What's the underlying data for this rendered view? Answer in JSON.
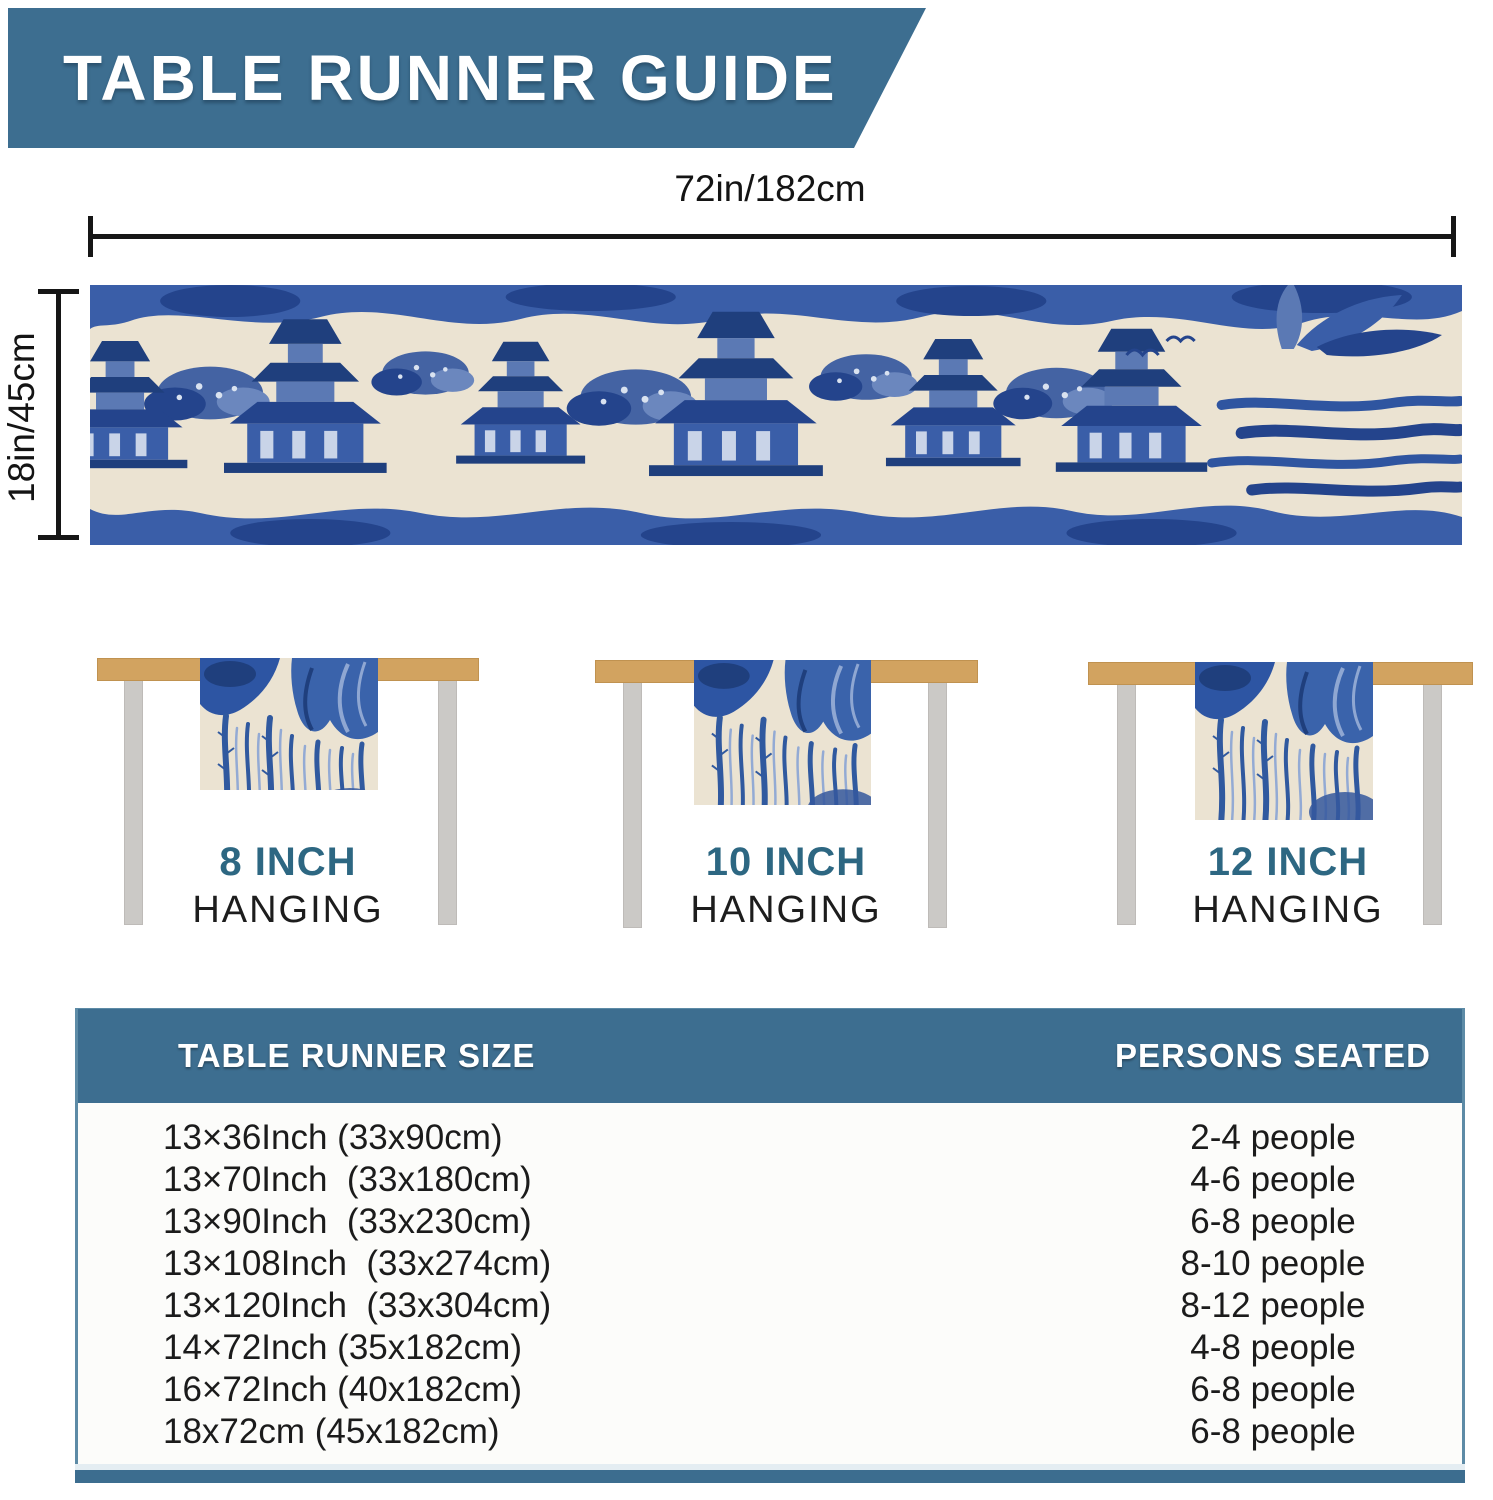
{
  "header": {
    "title": "TABLE RUNNER GUIDE"
  },
  "dimensions": {
    "width_label": "72in/182cm",
    "height_label": "18in/45cm"
  },
  "hanging_options": [
    {
      "size_label": "8 INCH",
      "sub_label": "HANGING"
    },
    {
      "size_label": "10 INCH",
      "sub_label": "HANGING"
    },
    {
      "size_label": "12 INCH",
      "sub_label": "HANGING"
    }
  ],
  "sizing_table": {
    "columns": [
      "TABLE RUNNER SIZE",
      "PERSONS SEATED"
    ],
    "rows": [
      {
        "size": "13×36Inch (33x90cm)",
        "persons": "2-4 people"
      },
      {
        "size": "13×70Inch  (33x180cm)",
        "persons": "4-6 people"
      },
      {
        "size": "13×90Inch  (33x230cm)",
        "persons": "6-8 people"
      },
      {
        "size": "13×108Inch  (33x274cm)",
        "persons": "8-10 people"
      },
      {
        "size": "13×120Inch  (33x304cm)",
        "persons": "8-12 people"
      },
      {
        "size": "14×72Inch (35x182cm)",
        "persons": "4-8 people"
      },
      {
        "size": "16×72Inch (40x182cm)",
        "persons": "6-8 people"
      },
      {
        "size": "18x72cm (45x182cm)",
        "persons": "6-8 people"
      }
    ]
  },
  "colors": {
    "banner": "#3D6E90",
    "hanging_label": "#2D6782",
    "tabletop": "#D2A360",
    "table_leg": "#CBC9C6",
    "toile_dark_blue": "#24448C",
    "toile_blue": "#3A5EA8",
    "toile_cream": "#EBE3D2",
    "body_text": "#1B1B1B"
  }
}
